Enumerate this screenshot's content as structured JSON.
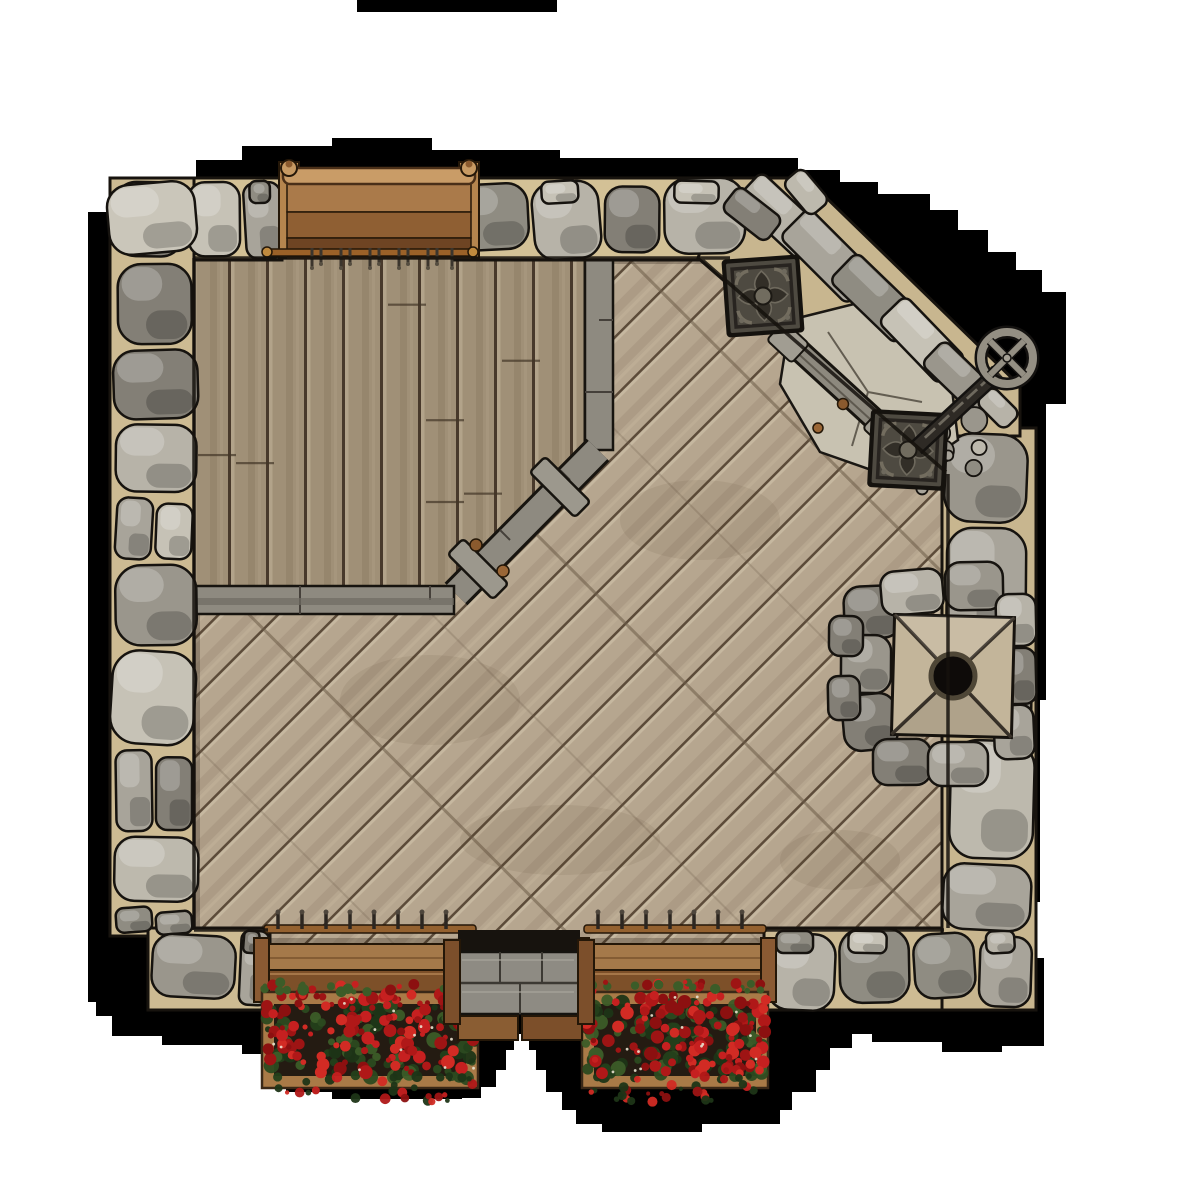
{
  "map": {
    "title": "Top-down tavern deck battle map tile with stone walls",
    "style": "fantasy VTT map asset on white page with black drop shadow",
    "objects": [
      {
        "name": "stone-perimeter-wall",
        "material": "gray fieldstone with tan mortar"
      },
      {
        "name": "diagonal-plank-floor",
        "description": "weathered tan deck boards laid at 45 degrees"
      },
      {
        "name": "stage-platform",
        "description": "raised vertical-plank platform in north-west corner with gray trim rail and angled corner"
      },
      {
        "name": "railing-cleats",
        "count": 2
      },
      {
        "name": "wooden-bench",
        "description": "brown plank bench recessed in north wall with carved finial posts"
      },
      {
        "name": "coat-hook-rail",
        "hooks": 11
      },
      {
        "name": "ornate-floor-grate",
        "count": 2,
        "pattern": "quatrefoil in square metal frame"
      },
      {
        "name": "collapsed-wall-rubble",
        "description": "diagonal breach in north-east corner filled with stone slabs"
      },
      {
        "name": "wheel-crank",
        "description": "stone wheel with X-cross on dark ribbed shaft"
      },
      {
        "name": "stone-chimney",
        "description": "square cap with X seams and round black flue hole"
      },
      {
        "name": "window-sill-railing",
        "count": 2,
        "hooks_per_rail": 8
      },
      {
        "name": "flower-box",
        "count": 2,
        "flowers": "red blossoms with green foliage"
      },
      {
        "name": "wooden-steps",
        "description": "gray weathered landing with two lower brown treads at south entry"
      }
    ],
    "palette": {
      "page_background": "#ffffff",
      "shadow": "#000000",
      "floor_wood": "#b6a68f",
      "floor_seam": "#5c4b39",
      "stage_wood": "#a09077",
      "stone_light": "#c6c2b6",
      "stone_mid": "#a8a49a",
      "stone_dark": "#8f8c82",
      "mortar": "#d3c196",
      "bench_wood_light": "#c99c67",
      "bench_wood_dark": "#6e4423",
      "sill_wood": "#a5794a",
      "planter_wood": "#a97a47",
      "flower_red": "#c02020",
      "foliage_green": "#2c4a20",
      "grate_metal": "#4e4a41",
      "step_wood_gray": "#8e8b83",
      "chimney_stone": "#c3b59a"
    }
  }
}
